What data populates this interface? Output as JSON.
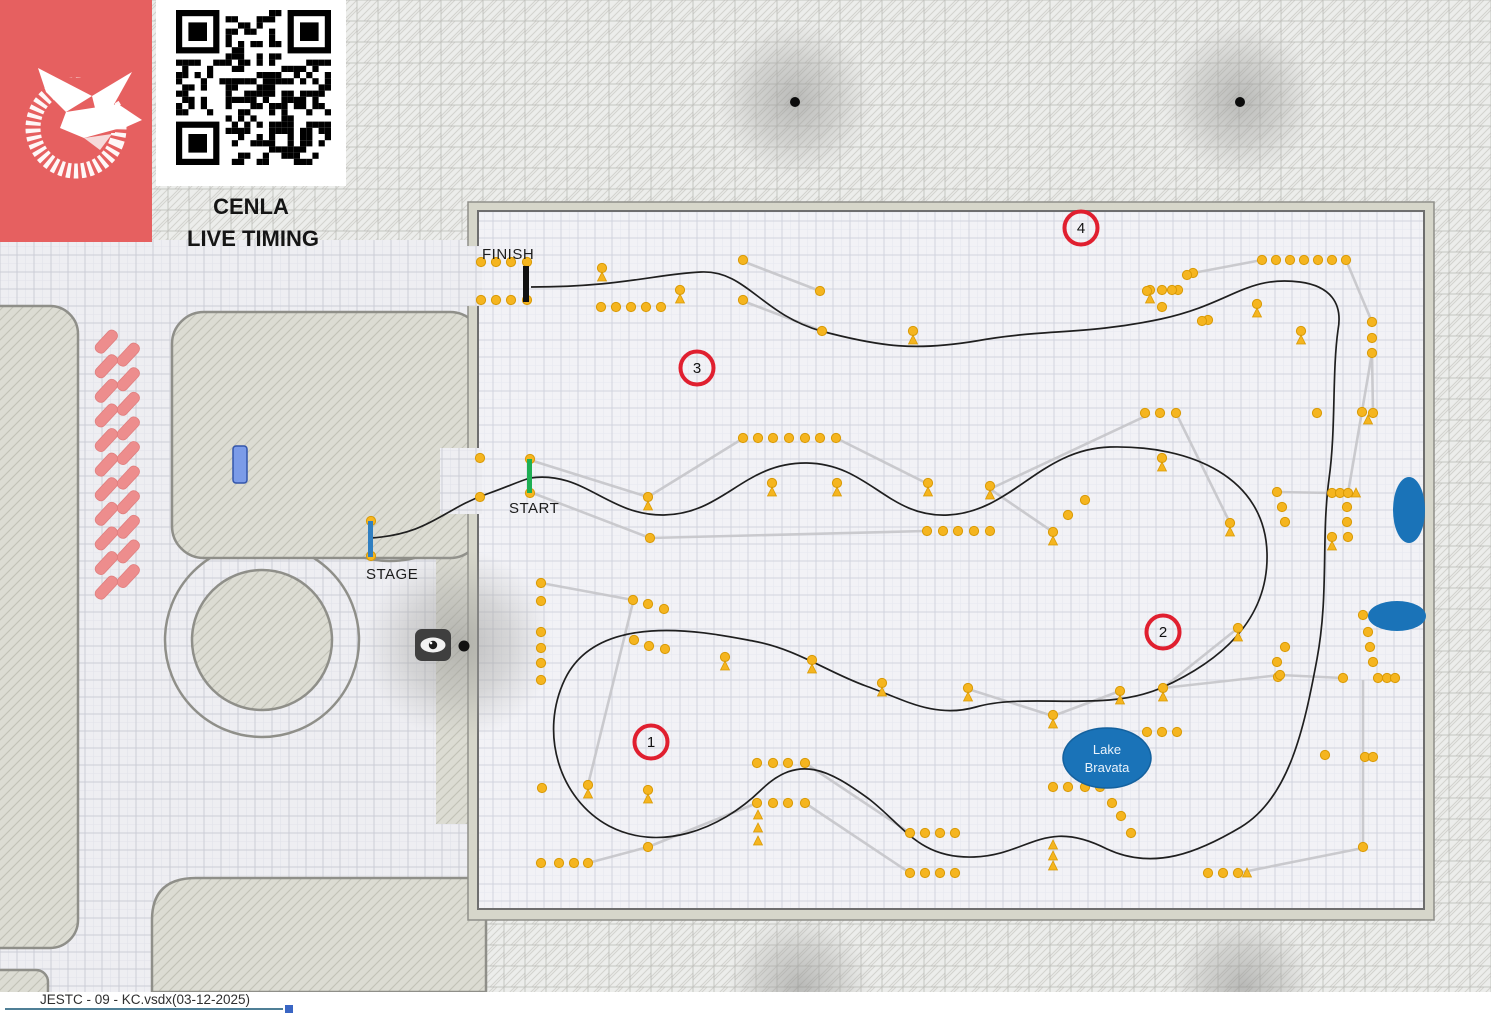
{
  "header": {
    "title_line1": "CENLA",
    "title_line2": "LIVE TIMING"
  },
  "labels": {
    "finish": "FINISH",
    "start": "START",
    "stage": "STAGE"
  },
  "footer": {
    "filename": "JESTC - 09 - KC.vsdx",
    "date": "(03-12-2025)"
  },
  "colors": {
    "logo_bg": "#e66060",
    "cone": "#f5b51f",
    "cone_stroke": "#d99a05",
    "course_path": "#1f1f1f",
    "connector": "#c6c6ca",
    "checkpoint_ring": "#e01f2f",
    "lake_fill": "#1a73b8",
    "start_line": "#1faf54",
    "stage_line": "#2f7fc1",
    "finish_line": "#111111",
    "parking_pink": "#ed8d8d",
    "marker_blue": "#7b9be8"
  },
  "map_data": {
    "checkpoints": [
      {
        "n": "1",
        "x": 651,
        "y": 742
      },
      {
        "n": "2",
        "x": 1163,
        "y": 632
      },
      {
        "n": "3",
        "x": 697,
        "y": 368
      },
      {
        "n": "4",
        "x": 1081,
        "y": 228
      }
    ],
    "lake": {
      "line1": "Lake",
      "line2": "Bravata",
      "x": 1107,
      "y": 758,
      "rx": 44,
      "ry": 30
    },
    "gates": {
      "finish": {
        "x": 523,
        "y": 266,
        "w": 6,
        "h": 36
      },
      "start": {
        "x": 527,
        "y": 459,
        "w": 5,
        "h": 34
      },
      "stage": {
        "x": 368,
        "y": 521,
        "w": 5,
        "h": 36
      }
    },
    "label_pos": {
      "finish": [
        482,
        259
      ],
      "start": [
        509,
        513
      ],
      "stage": [
        366,
        579
      ]
    },
    "blue_ellipses": [
      {
        "cx": 1409,
        "cy": 510,
        "rx": 16,
        "ry": 33
      },
      {
        "cx": 1397,
        "cy": 616,
        "rx": 29,
        "ry": 15
      }
    ],
    "trees": [
      {
        "x": 795,
        "y": 100,
        "r": 78,
        "dot": true
      },
      {
        "x": 1240,
        "y": 100,
        "r": 78,
        "dot": true
      },
      {
        "x": 800,
        "y": 986,
        "r": 72,
        "dot": false
      },
      {
        "x": 1243,
        "y": 986,
        "r": 72,
        "dot": false
      }
    ],
    "course_paths": [
      "M 371 538 C 430 534 443 509 487 494 C 507 487 517 482 530 478",
      "M 530 478 C 584 470 608 516 664 515 C 724 514 744 462 807 463 C 869 464 888 518 948 515 C 1012 512 1040 449 1110 447 C 1192 445 1265 478 1267 553 C 1269 622 1217 663 1161 688 C 1104 713 1028 692 976 707 C 934 719 903 699 866 686 C 827 672 797 649 753 641 C 710 633 599 609 565 679 C 539 733 559 799 609 826 C 659 852 719 831 761 790 C 799 753 829 770 869 799 C 904 826 919 859 974 857 C 1029 855 1044 817 1107 849 C 1154 871 1199 852 1241 827 C 1289 798 1304 729 1317 659 C 1329 594 1321 539 1329 479 C 1336 429 1332 373 1338 330",
      "M 1338 330 C 1343 303 1330 286 1300 282 C 1246 275 1231 304 1161 319 C 1086 335 1041 329 976 341 C 916 351 881 347 821 331 C 761 314 746 270 701 272 C 656 274 621 287 531 287"
    ],
    "connectors": [
      [
        530,
        460,
        648,
        497
      ],
      [
        648,
        497,
        742,
        439
      ],
      [
        530,
        492,
        650,
        538
      ],
      [
        650,
        538,
        925,
        531
      ],
      [
        742,
        261,
        820,
        291
      ],
      [
        743,
        301,
        822,
        331
      ],
      [
        836,
        438,
        928,
        484
      ],
      [
        1193,
        273,
        1262,
        260
      ],
      [
        1346,
        260,
        1372,
        322
      ],
      [
        1372,
        353,
        1348,
        493
      ],
      [
        1150,
        414,
        990,
        489
      ],
      [
        1176,
        413,
        1230,
        523
      ],
      [
        990,
        489,
        1053,
        532
      ],
      [
        1277,
        492,
        1332,
        493
      ],
      [
        1373,
        413,
        1372,
        353
      ],
      [
        1238,
        628,
        1163,
        688
      ],
      [
        1280,
        675,
        1343,
        678
      ],
      [
        1363,
        680,
        1363,
        845
      ],
      [
        1238,
        873,
        1363,
        848
      ],
      [
        968,
        689,
        1053,
        716
      ],
      [
        1053,
        716,
        1120,
        691
      ],
      [
        1163,
        688,
        1280,
        675
      ],
      [
        541,
        583,
        633,
        600
      ],
      [
        633,
        602,
        588,
        785
      ],
      [
        588,
        863,
        648,
        847
      ],
      [
        648,
        847,
        757,
        803
      ],
      [
        805,
        763,
        910,
        833
      ],
      [
        805,
        803,
        910,
        873
      ]
    ],
    "cones": [
      [
        481,
        262
      ],
      [
        496,
        262
      ],
      [
        511,
        262
      ],
      [
        527,
        262
      ],
      [
        481,
        300
      ],
      [
        496,
        300
      ],
      [
        511,
        300
      ],
      [
        527,
        300
      ],
      [
        601,
        307
      ],
      [
        616,
        307
      ],
      [
        631,
        307
      ],
      [
        646,
        307
      ],
      [
        661,
        307
      ],
      [
        602,
        268
      ],
      [
        680,
        290
      ],
      [
        743,
        260
      ],
      [
        743,
        300
      ],
      [
        820,
        291
      ],
      [
        822,
        331
      ],
      [
        913,
        331
      ],
      [
        1150,
        290
      ],
      [
        1162,
        290
      ],
      [
        1162,
        307
      ],
      [
        1178,
        290
      ],
      [
        1193,
        273
      ],
      [
        1262,
        260
      ],
      [
        1276,
        260
      ],
      [
        1290,
        260
      ],
      [
        1304,
        260
      ],
      [
        1318,
        260
      ],
      [
        1332,
        260
      ],
      [
        1346,
        260
      ],
      [
        1208,
        320
      ],
      [
        1372,
        322
      ],
      [
        1372,
        338
      ],
      [
        1372,
        353
      ],
      [
        1301,
        331
      ],
      [
        1257,
        304
      ],
      [
        1147,
        291
      ],
      [
        1172,
        290
      ],
      [
        1187,
        275
      ],
      [
        1202,
        321
      ],
      [
        743,
        438
      ],
      [
        758,
        438
      ],
      [
        773,
        438
      ],
      [
        789,
        438
      ],
      [
        805,
        438
      ],
      [
        820,
        438
      ],
      [
        836,
        438
      ],
      [
        648,
        497
      ],
      [
        650,
        538
      ],
      [
        772,
        483
      ],
      [
        837,
        483
      ],
      [
        928,
        483
      ],
      [
        927,
        531
      ],
      [
        943,
        531
      ],
      [
        958,
        531
      ],
      [
        974,
        531
      ],
      [
        990,
        531
      ],
      [
        530,
        459
      ],
      [
        530,
        493
      ],
      [
        480,
        458
      ],
      [
        480,
        497
      ],
      [
        371,
        521
      ],
      [
        371,
        556
      ],
      [
        1145,
        413
      ],
      [
        1160,
        413
      ],
      [
        1176,
        413
      ],
      [
        1162,
        458
      ],
      [
        990,
        486
      ],
      [
        1085,
        500
      ],
      [
        1068,
        515
      ],
      [
        1053,
        532
      ],
      [
        1230,
        523
      ],
      [
        1277,
        492
      ],
      [
        1282,
        507
      ],
      [
        1285,
        522
      ],
      [
        1332,
        493
      ],
      [
        1340,
        493
      ],
      [
        1348,
        493
      ],
      [
        1347,
        507
      ],
      [
        1347,
        522
      ],
      [
        1332,
        537
      ],
      [
        1348,
        537
      ],
      [
        1317,
        413
      ],
      [
        1362,
        412
      ],
      [
        1373,
        413
      ],
      [
        1238,
        628
      ],
      [
        1285,
        647
      ],
      [
        1277,
        662
      ],
      [
        1278,
        677
      ],
      [
        1363,
        615
      ],
      [
        1368,
        632
      ],
      [
        1370,
        647
      ],
      [
        1373,
        662
      ],
      [
        1378,
        678
      ],
      [
        1387,
        678
      ],
      [
        1395,
        678
      ],
      [
        1343,
        678
      ],
      [
        968,
        688
      ],
      [
        1053,
        715
      ],
      [
        1163,
        688
      ],
      [
        1120,
        691
      ],
      [
        1147,
        732
      ],
      [
        1162,
        732
      ],
      [
        1177,
        732
      ],
      [
        1053,
        787
      ],
      [
        1068,
        787
      ],
      [
        1085,
        787
      ],
      [
        1100,
        787
      ],
      [
        1112,
        803
      ],
      [
        1121,
        816
      ],
      [
        1131,
        833
      ],
      [
        910,
        833
      ],
      [
        925,
        833
      ],
      [
        940,
        833
      ],
      [
        955,
        833
      ],
      [
        910,
        873
      ],
      [
        925,
        873
      ],
      [
        940,
        873
      ],
      [
        955,
        873
      ],
      [
        1208,
        873
      ],
      [
        1223,
        873
      ],
      [
        1238,
        873
      ],
      [
        1363,
        847
      ],
      [
        1325,
        755
      ],
      [
        1365,
        757
      ],
      [
        1373,
        757
      ],
      [
        1280,
        675
      ],
      [
        541,
        583
      ],
      [
        541,
        601
      ],
      [
        541,
        632
      ],
      [
        541,
        648
      ],
      [
        541,
        663
      ],
      [
        541,
        680
      ],
      [
        633,
        600
      ],
      [
        648,
        604
      ],
      [
        664,
        609
      ],
      [
        634,
        640
      ],
      [
        649,
        646
      ],
      [
        665,
        649
      ],
      [
        725,
        657
      ],
      [
        812,
        660
      ],
      [
        882,
        683
      ],
      [
        542,
        788
      ],
      [
        588,
        785
      ],
      [
        648,
        790
      ],
      [
        757,
        763
      ],
      [
        773,
        763
      ],
      [
        788,
        763
      ],
      [
        805,
        763
      ],
      [
        757,
        803
      ],
      [
        773,
        803
      ],
      [
        788,
        803
      ],
      [
        805,
        803
      ],
      [
        541,
        863
      ],
      [
        559,
        863
      ],
      [
        574,
        863
      ],
      [
        588,
        863
      ],
      [
        648,
        847
      ]
    ],
    "triangles": [
      [
        602,
        277
      ],
      [
        680,
        299
      ],
      [
        913,
        340
      ],
      [
        1150,
        299
      ],
      [
        1301,
        340
      ],
      [
        1257,
        313
      ],
      [
        648,
        506
      ],
      [
        772,
        492
      ],
      [
        837,
        492
      ],
      [
        928,
        492
      ],
      [
        1162,
        467
      ],
      [
        990,
        495
      ],
      [
        1053,
        541
      ],
      [
        1230,
        532
      ],
      [
        1332,
        546
      ],
      [
        1238,
        637
      ],
      [
        968,
        697
      ],
      [
        1053,
        724
      ],
      [
        1163,
        697
      ],
      [
        1120,
        700
      ],
      [
        1053,
        845
      ],
      [
        1053,
        856
      ],
      [
        1053,
        866
      ],
      [
        758,
        815
      ],
      [
        758,
        828
      ],
      [
        758,
        841
      ],
      [
        588,
        794
      ],
      [
        648,
        799
      ],
      [
        725,
        666
      ],
      [
        812,
        669
      ],
      [
        882,
        692
      ],
      [
        1247,
        873
      ],
      [
        1356,
        493
      ],
      [
        1368,
        420
      ]
    ]
  }
}
